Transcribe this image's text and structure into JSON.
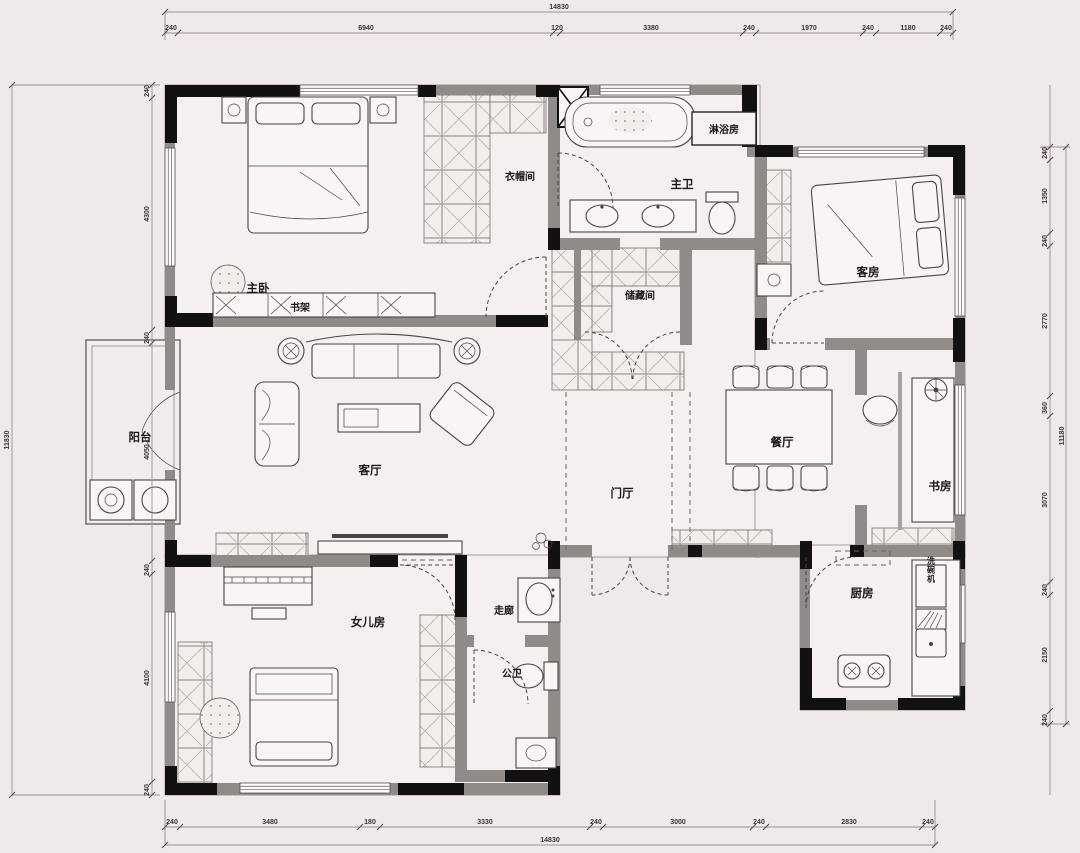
{
  "title": "apartment-floor-plan",
  "colors": {
    "background": "#efe9e9",
    "floor": "#f5f0ef",
    "wall_grey": "#8f8b89",
    "wall_black": "#121111",
    "drawing_line": "#4a4443",
    "dimension_text": "#3c3333"
  },
  "rooms": {
    "master_bedroom": "主卧",
    "bookshelf": "书架",
    "cloakroom": "衣帽间",
    "master_bath": "主卫",
    "shower_room": "淋浴房",
    "guest_room": "客房",
    "storage": "储藏间",
    "living_room": "客厅",
    "balcony": "阳台",
    "dining_room": "餐厅",
    "study": "书房",
    "foyer": "门厅",
    "corridor": "走廊",
    "guest_bath": "公卫",
    "daughter_room": "女儿房",
    "kitchen": "厨房",
    "dishwasher": "洗碗机"
  },
  "dims": {
    "top_total": "14830",
    "top": [
      "240",
      "6940",
      "120",
      "3380",
      "240",
      "1970",
      "240",
      "1180",
      "240"
    ],
    "bottom_total": "14830",
    "bottom": [
      "240",
      "3480",
      "180",
      "3330",
      "240",
      "3000",
      "240",
      "2830",
      "240"
    ],
    "left_total": "11830",
    "left": [
      "240",
      "4300",
      "240",
      "4050",
      "240",
      "4100",
      "240"
    ],
    "right_total": "11180",
    "right": [
      "240",
      "1350",
      "240",
      "2770",
      "360",
      "3070",
      "240",
      "2150",
      "240"
    ]
  }
}
